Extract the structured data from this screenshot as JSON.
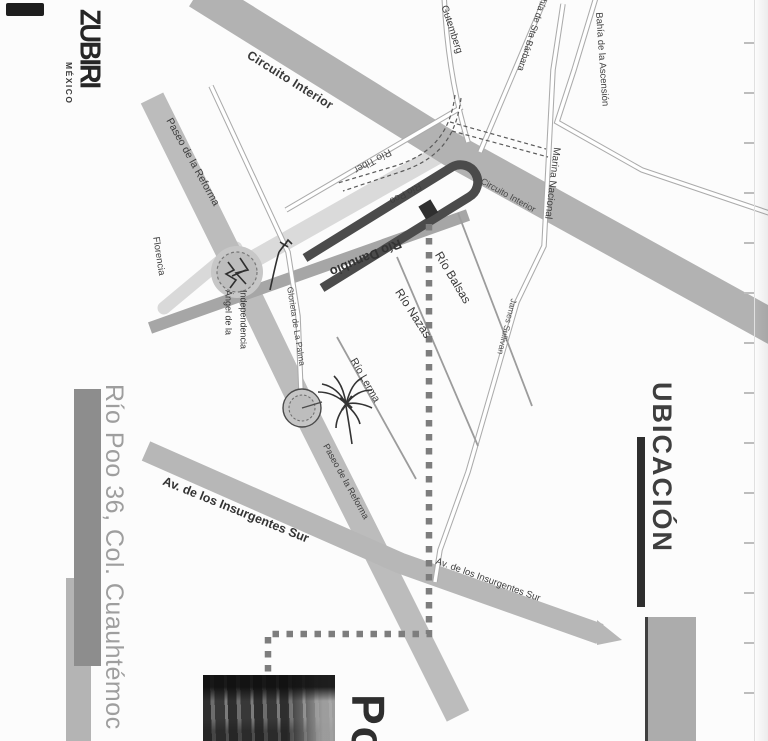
{
  "logo": {
    "brand": "ZUBIRI",
    "country": "MÉXICO"
  },
  "address_title": "Río Poo 36, Col. Cuauhtémoc",
  "section_title": "UBICACIÓN",
  "photo_caption": "Po",
  "map": {
    "streets": {
      "circuito_interior_main": "Circuito Interior",
      "circuito_interior_small": "Circuito Interior",
      "paseo_reforma_upper": "Paseo de la Reforma",
      "paseo_reforma_lower": "Paseo de la Reforma",
      "insurgentes_left": "Av. de los Insurgentes Sur",
      "insurgentes_right": "Av. de los Insurgentes Sur",
      "gutemberg": "Gutemberg",
      "bahia_sta_barbara": "Bahía de Sta Bárbara",
      "bahia_ascension": "Bahía de la Ascensión",
      "marina_nacional": "Marina Nacional",
      "james_sullivan": "James Sullivan",
      "rio_tiber": "Río Tiber",
      "rio_poo": "Río Poo",
      "rio_danubio": "Río Danubio",
      "rio_balsas": "Río Balsas",
      "rio_nazas": "Río Nazas",
      "rio_lerma": "Río Lerma",
      "florencia": "Florencia"
    },
    "landmarks": {
      "angel_line1": "Ángel de la",
      "angel_line2": "Independencia",
      "glorieta_la_palma": "Glorieta de La Palma"
    }
  },
  "colors": {
    "page_bg": "#fcfcfc",
    "road_gray": "#b7b7b7",
    "road_light": "#dadada",
    "road_dark": "#4b4b4b",
    "dotted_route": "#7d7d7d",
    "ink": "#333333",
    "address_gray": "#9e9e9e",
    "section_ink": "#3e3e3e"
  }
}
